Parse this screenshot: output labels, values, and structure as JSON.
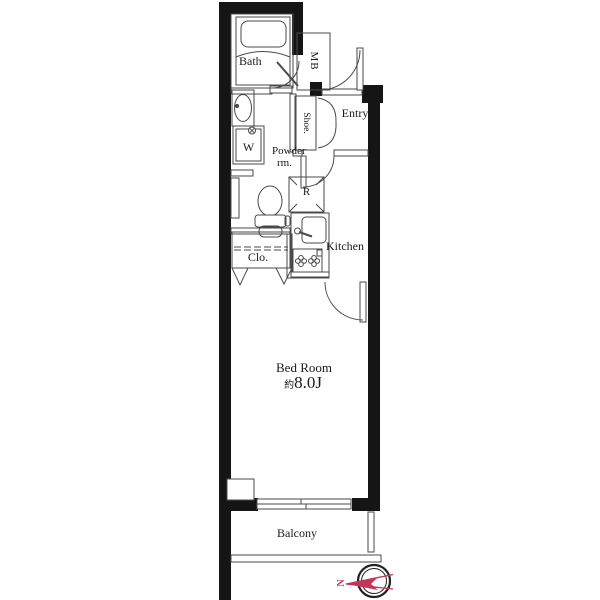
{
  "rooms": {
    "bath": {
      "label": "Bath"
    },
    "meter_box": {
      "label": "MB"
    },
    "entry": {
      "label": "Entry"
    },
    "shoe_cabinet": {
      "label": "Shoe."
    },
    "powder_room": {
      "line1": "Powder",
      "line2": "rm."
    },
    "washer": {
      "label": "W"
    },
    "refrigerator": {
      "label": "R"
    },
    "kitchen": {
      "label": "Kitchen"
    },
    "closet": {
      "label": "Clo."
    },
    "bedroom": {
      "label": "Bed Room",
      "area_prefix": "約",
      "area_value": "8.0J"
    },
    "balcony": {
      "label": "Balcony"
    }
  },
  "compass": {
    "north": "N"
  },
  "colors": {
    "wall": "#151515",
    "line": "#4a4a4a",
    "needle": "#c43556",
    "background": "#ffffff"
  }
}
